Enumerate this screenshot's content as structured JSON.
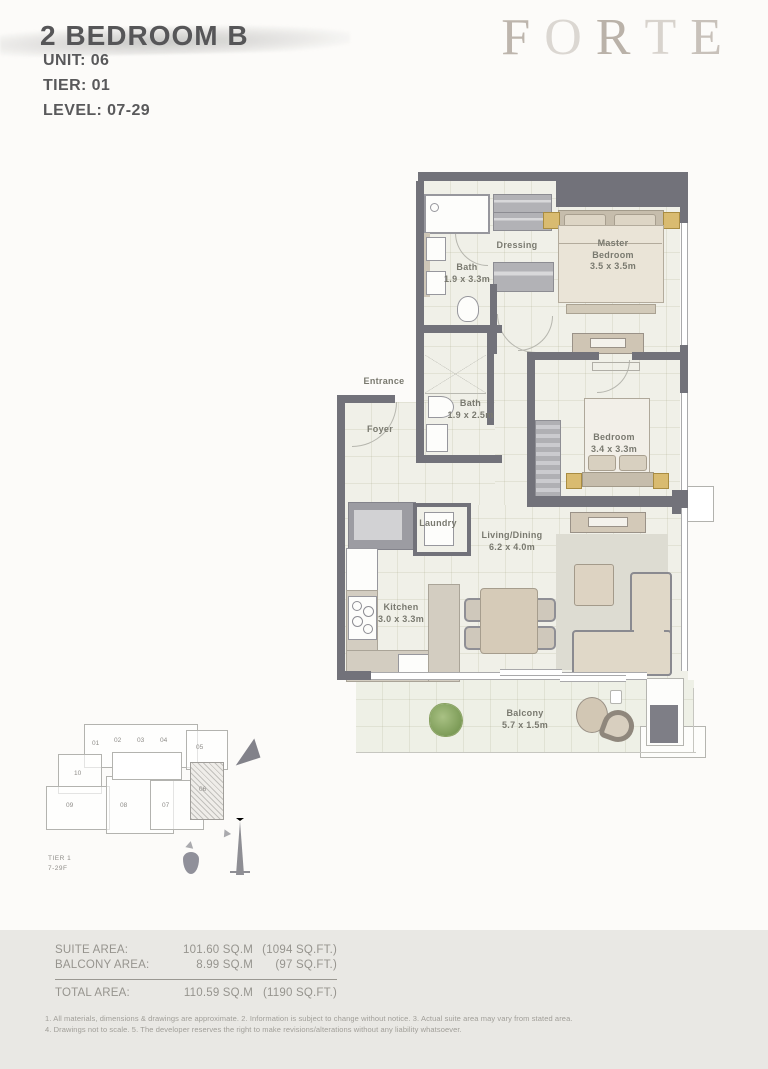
{
  "header": {
    "title": "2 BEDROOM B",
    "unit": "UNIT: 06",
    "tier": "TIER: 01",
    "level": "LEVEL: 07-29",
    "logo_letters": [
      "F",
      "O",
      "R",
      "T",
      "E"
    ]
  },
  "plan": {
    "rooms": {
      "dressing": {
        "name": "Dressing",
        "dims": ""
      },
      "bath1": {
        "name": "Bath",
        "dims": "1.9 x 3.3m"
      },
      "master": {
        "name": "Master Bedroom",
        "dims": "3.5 x 3.5m"
      },
      "entrance": {
        "name": "Entrance",
        "dims": ""
      },
      "foyer": {
        "name": "Foyer",
        "dims": ""
      },
      "bath2": {
        "name": "Bath",
        "dims": "1.9 x 2.5m"
      },
      "bedroom": {
        "name": "Bedroom",
        "dims": "3.4 x 3.3m"
      },
      "laundry": {
        "name": "Laundry",
        "dims": ""
      },
      "living": {
        "name": "Living/Dining",
        "dims": "6.2 x 4.0m"
      },
      "kitchen": {
        "name": "Kitchen",
        "dims": "3.0 x 3.3m"
      },
      "balcony": {
        "name": "Balcony",
        "dims": "5.7 x 1.5m"
      }
    }
  },
  "keyplan": {
    "units": [
      "01",
      "02",
      "03",
      "04",
      "05",
      "10",
      "09",
      "08",
      "07"
    ],
    "highlighted_unit": "06",
    "tier_label": "TIER 1",
    "levels_label": "7-29F"
  },
  "areas": {
    "suite": {
      "label": "SUITE AREA:",
      "sqm": "101.60 SQ.M",
      "sqft": "(1094 SQ.FT.)"
    },
    "balcony": {
      "label": "BALCONY AREA:",
      "sqm": "8.99 SQ.M",
      "sqft": "(97 SQ.FT.)"
    },
    "total": {
      "label": "TOTAL AREA:",
      "sqm": "110.59 SQ.M",
      "sqft": "(1190 SQ.FT.)"
    }
  },
  "disclaimer": {
    "line1": "1. All materials, dimensions & drawings are approximate. 2. Information is subject to change without notice. 3. Actual suite area may vary from stated area.",
    "line2": "4. Drawings not to scale. 5. The developer reserves the right to make revisions/alterations without any liability whatsoever."
  },
  "colors": {
    "wall": "#72727a",
    "floor": "#f0f0e8",
    "accent_beige": "#d5cbba",
    "logo": "#b5aca3",
    "text": "#565658"
  }
}
